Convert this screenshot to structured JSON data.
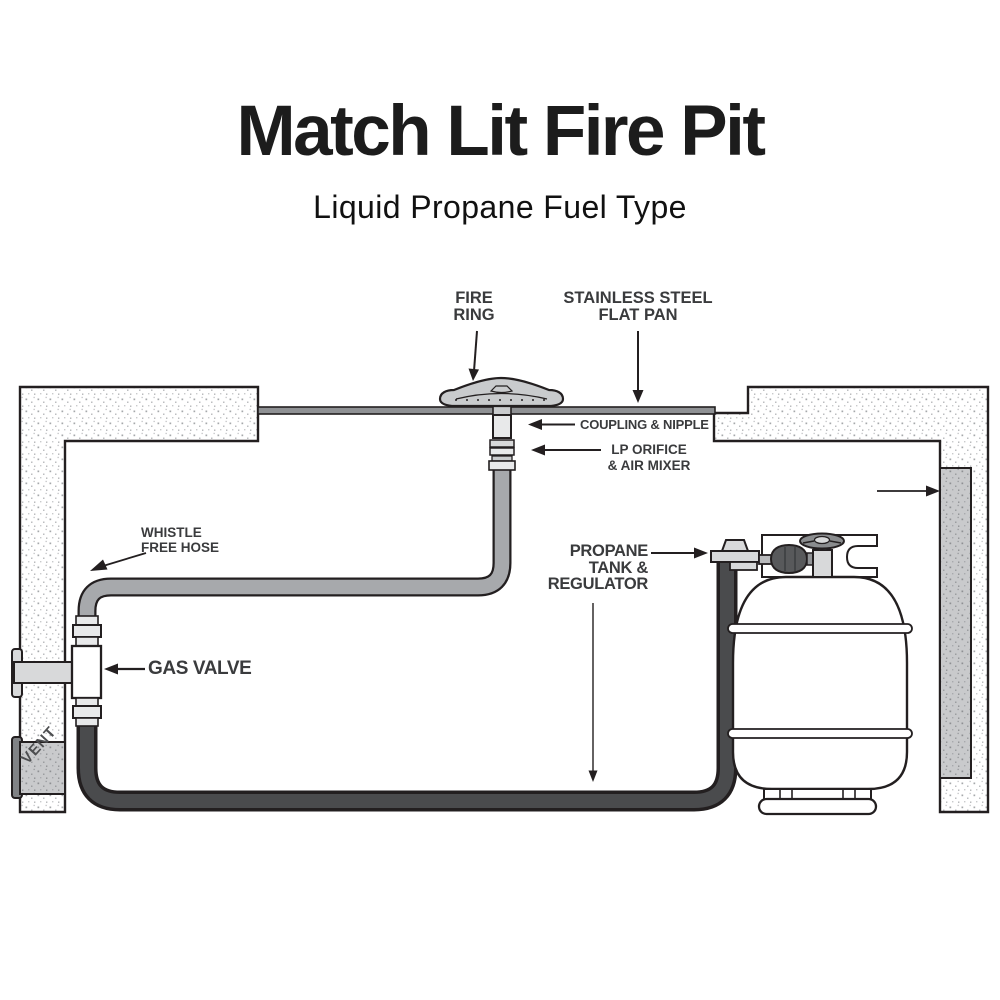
{
  "header": {
    "title": "Match Lit Fire Pit",
    "subtitle": "Liquid Propane Fuel Type"
  },
  "diagram": {
    "labels": {
      "fire_ring": {
        "line1": "FIRE",
        "line2": "RING"
      },
      "flat_pan": {
        "line1": "STAINLESS STEEL",
        "line2": "FLAT PAN"
      },
      "coupling": "COUPLING & NIPPLE",
      "lp_orifice": {
        "line1": "LP ORIFICE",
        "line2": "& AIR MIXER"
      },
      "whistle_hose": {
        "line1": "WHISTLE",
        "line2": "FREE HOSE"
      },
      "gas_valve": "GAS VALVE",
      "propane_tank": {
        "line1": "PROPANE",
        "line2": "TANK &",
        "line3": "REGULATOR"
      },
      "vent": "VENT"
    },
    "components": [
      "fire-ring",
      "stainless-steel-flat-pan",
      "coupling-and-nipple",
      "lp-orifice-and-air-mixer",
      "whistle-free-hose",
      "gas-valve",
      "propane-tank-and-regulator",
      "vent",
      "enclosure-walls"
    ],
    "colors": {
      "title_text": "#1c1c1c",
      "label_text": "#3a3b3d",
      "outline": "#231f20",
      "hose_gray": "#a7a9ac",
      "hose_dark": "#4a4b4d",
      "pan_gray": "#8f9194",
      "fitting_light": "#e8e9ea",
      "metal_gray": "#d8d9da",
      "panel_gray": "#c9cacc",
      "regulator_dark": "#58595b",
      "vent_flange": "#808285"
    }
  }
}
